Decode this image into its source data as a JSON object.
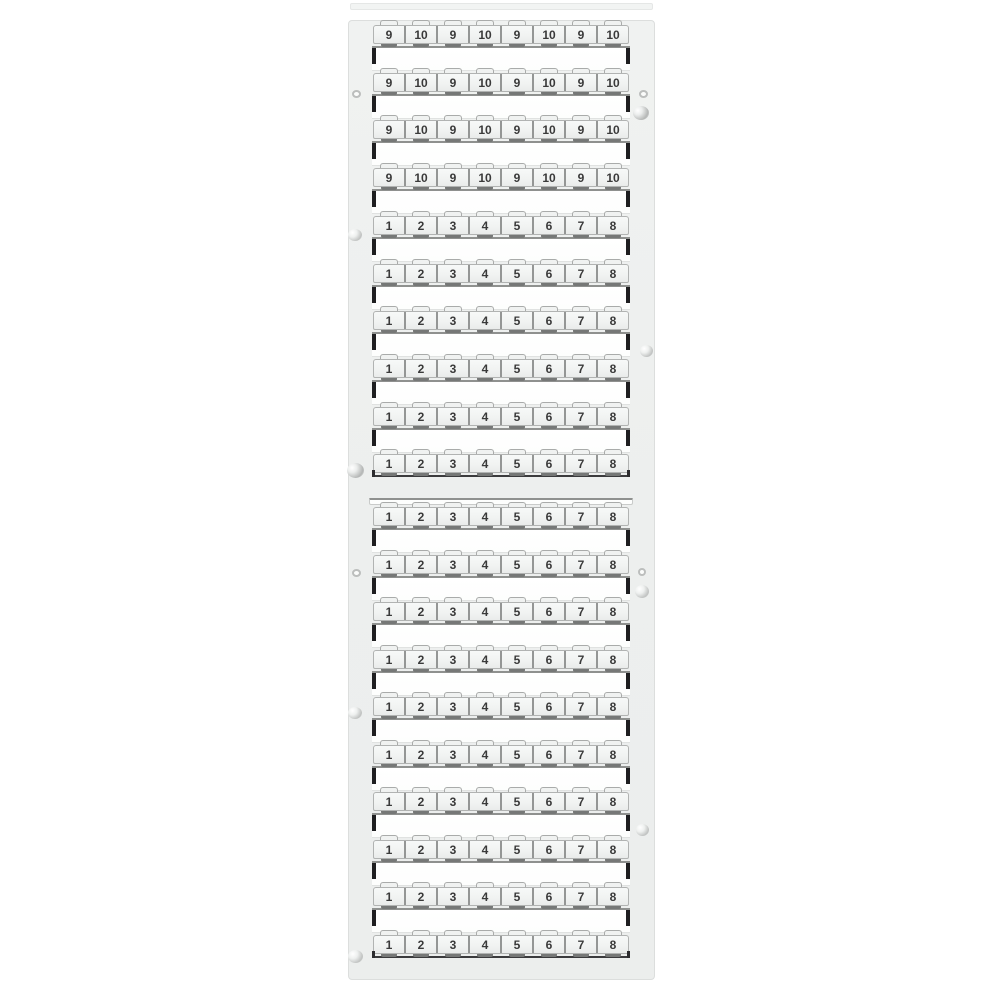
{
  "photo": {
    "object_label": "terminal-block-marker-card",
    "background_color": "#ffffff",
    "card_color": "#edefee",
    "tag_text_color": "#3a3a3a"
  },
  "card": {
    "upper_section": {
      "rows": [
        {
          "cells": [
            "9",
            "10",
            "9",
            "10",
            "9",
            "10",
            "9",
            "10"
          ]
        },
        {
          "cells": [
            "9",
            "10",
            "9",
            "10",
            "9",
            "10",
            "9",
            "10"
          ]
        },
        {
          "cells": [
            "9",
            "10",
            "9",
            "10",
            "9",
            "10",
            "9",
            "10"
          ]
        },
        {
          "cells": [
            "9",
            "10",
            "9",
            "10",
            "9",
            "10",
            "9",
            "10"
          ]
        },
        {
          "cells": [
            "1",
            "2",
            "3",
            "4",
            "5",
            "6",
            "7",
            "8"
          ]
        },
        {
          "cells": [
            "1",
            "2",
            "3",
            "4",
            "5",
            "6",
            "7",
            "8"
          ]
        },
        {
          "cells": [
            "1",
            "2",
            "3",
            "4",
            "5",
            "6",
            "7",
            "8"
          ]
        },
        {
          "cells": [
            "1",
            "2",
            "3",
            "4",
            "5",
            "6",
            "7",
            "8"
          ]
        },
        {
          "cells": [
            "1",
            "2",
            "3",
            "4",
            "5",
            "6",
            "7",
            "8"
          ]
        },
        {
          "cells": [
            "1",
            "2",
            "3",
            "4",
            "5",
            "6",
            "7",
            "8"
          ]
        }
      ]
    },
    "lower_section": {
      "rows": [
        {
          "cells": [
            "1",
            "2",
            "3",
            "4",
            "5",
            "6",
            "7",
            "8"
          ]
        },
        {
          "cells": [
            "1",
            "2",
            "3",
            "4",
            "5",
            "6",
            "7",
            "8"
          ]
        },
        {
          "cells": [
            "1",
            "2",
            "3",
            "4",
            "5",
            "6",
            "7",
            "8"
          ]
        },
        {
          "cells": [
            "1",
            "2",
            "3",
            "4",
            "5",
            "6",
            "7",
            "8"
          ]
        },
        {
          "cells": [
            "1",
            "2",
            "3",
            "4",
            "5",
            "6",
            "7",
            "8"
          ]
        },
        {
          "cells": [
            "1",
            "2",
            "3",
            "4",
            "5",
            "6",
            "7",
            "8"
          ]
        },
        {
          "cells": [
            "1",
            "2",
            "3",
            "4",
            "5",
            "6",
            "7",
            "8"
          ]
        },
        {
          "cells": [
            "1",
            "2",
            "3",
            "4",
            "5",
            "6",
            "7",
            "8"
          ]
        },
        {
          "cells": [
            "1",
            "2",
            "3",
            "4",
            "5",
            "6",
            "7",
            "8"
          ]
        },
        {
          "cells": [
            "1",
            "2",
            "3",
            "4",
            "5",
            "6",
            "7",
            "8"
          ]
        }
      ]
    },
    "marks": [
      {
        "type": "pin",
        "side": "left",
        "x": 3,
        "y": 69,
        "w": 9,
        "h": 8
      },
      {
        "type": "smudge",
        "side": "left",
        "x": -1,
        "y": 208,
        "w": 14,
        "h": 12
      },
      {
        "type": "smudge-big",
        "side": "left",
        "x": -2,
        "y": 442,
        "w": 17,
        "h": 15
      },
      {
        "type": "pin",
        "side": "left",
        "x": 3,
        "y": 548,
        "w": 9,
        "h": 8
      },
      {
        "type": "smudge",
        "side": "left",
        "x": -1,
        "y": 686,
        "w": 14,
        "h": 12
      },
      {
        "type": "smudge",
        "side": "left",
        "x": -1,
        "y": 929,
        "w": 15,
        "h": 13
      },
      {
        "type": "pin",
        "side": "right",
        "x": 290,
        "y": 69,
        "w": 9,
        "h": 8
      },
      {
        "type": "smudge-big",
        "side": "right",
        "x": 284,
        "y": 85,
        "w": 16,
        "h": 14
      },
      {
        "type": "smudge",
        "side": "right",
        "x": 291,
        "y": 324,
        "w": 13,
        "h": 12
      },
      {
        "type": "pin",
        "side": "right",
        "x": 289,
        "y": 547,
        "w": 8,
        "h": 8
      },
      {
        "type": "smudge",
        "side": "right",
        "x": 286,
        "y": 564,
        "w": 14,
        "h": 13
      },
      {
        "type": "smudge",
        "side": "right",
        "x": 287,
        "y": 803,
        "w": 13,
        "h": 12
      }
    ]
  }
}
